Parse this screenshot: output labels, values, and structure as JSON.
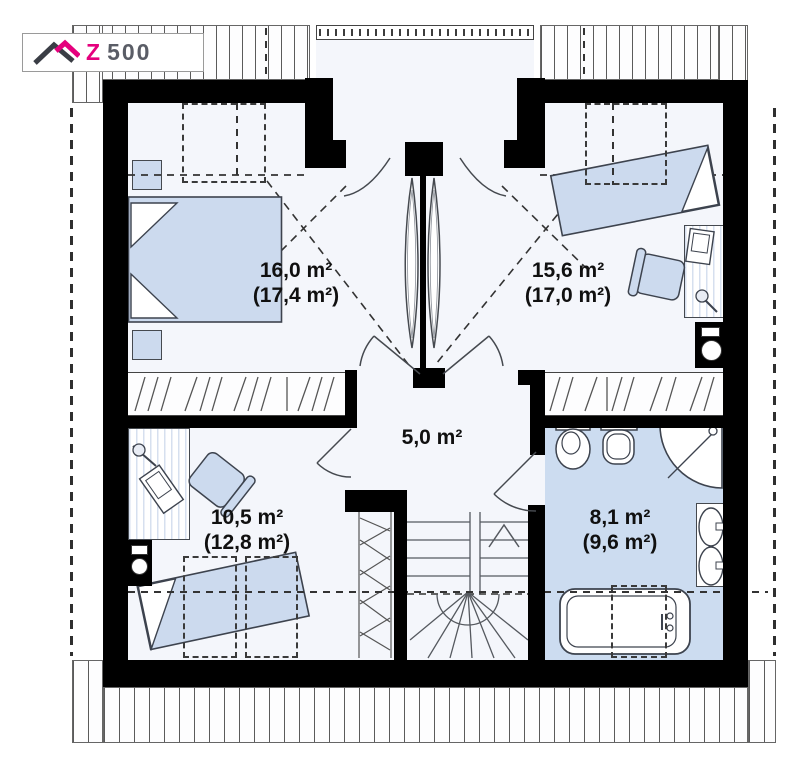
{
  "logo": {
    "z": "Z",
    "suffix": "500"
  },
  "colors": {
    "wall": "#000000",
    "furniture_fill": "#ccdaee",
    "bathroom_floor": "#ccdcf0",
    "accent_pink": "#e5007d",
    "room_fill": "#f4f6fb",
    "line": "#45494f"
  },
  "rooms": [
    {
      "name": "bedroom-top-left",
      "area": "16,0 m²",
      "area_with_slopes": "(17,4 m²)"
    },
    {
      "name": "bedroom-top-right",
      "area": "15,6 m²",
      "area_with_slopes": "(17,0 m²)"
    },
    {
      "name": "hallway",
      "area": "5,0 m²",
      "area_with_slopes": ""
    },
    {
      "name": "bedroom-bottom-left",
      "area": "10,5 m²",
      "area_with_slopes": "(12,8 m²)"
    },
    {
      "name": "bathroom",
      "area": "8,1 m²",
      "area_with_slopes": "(9,6 m²)"
    }
  ]
}
